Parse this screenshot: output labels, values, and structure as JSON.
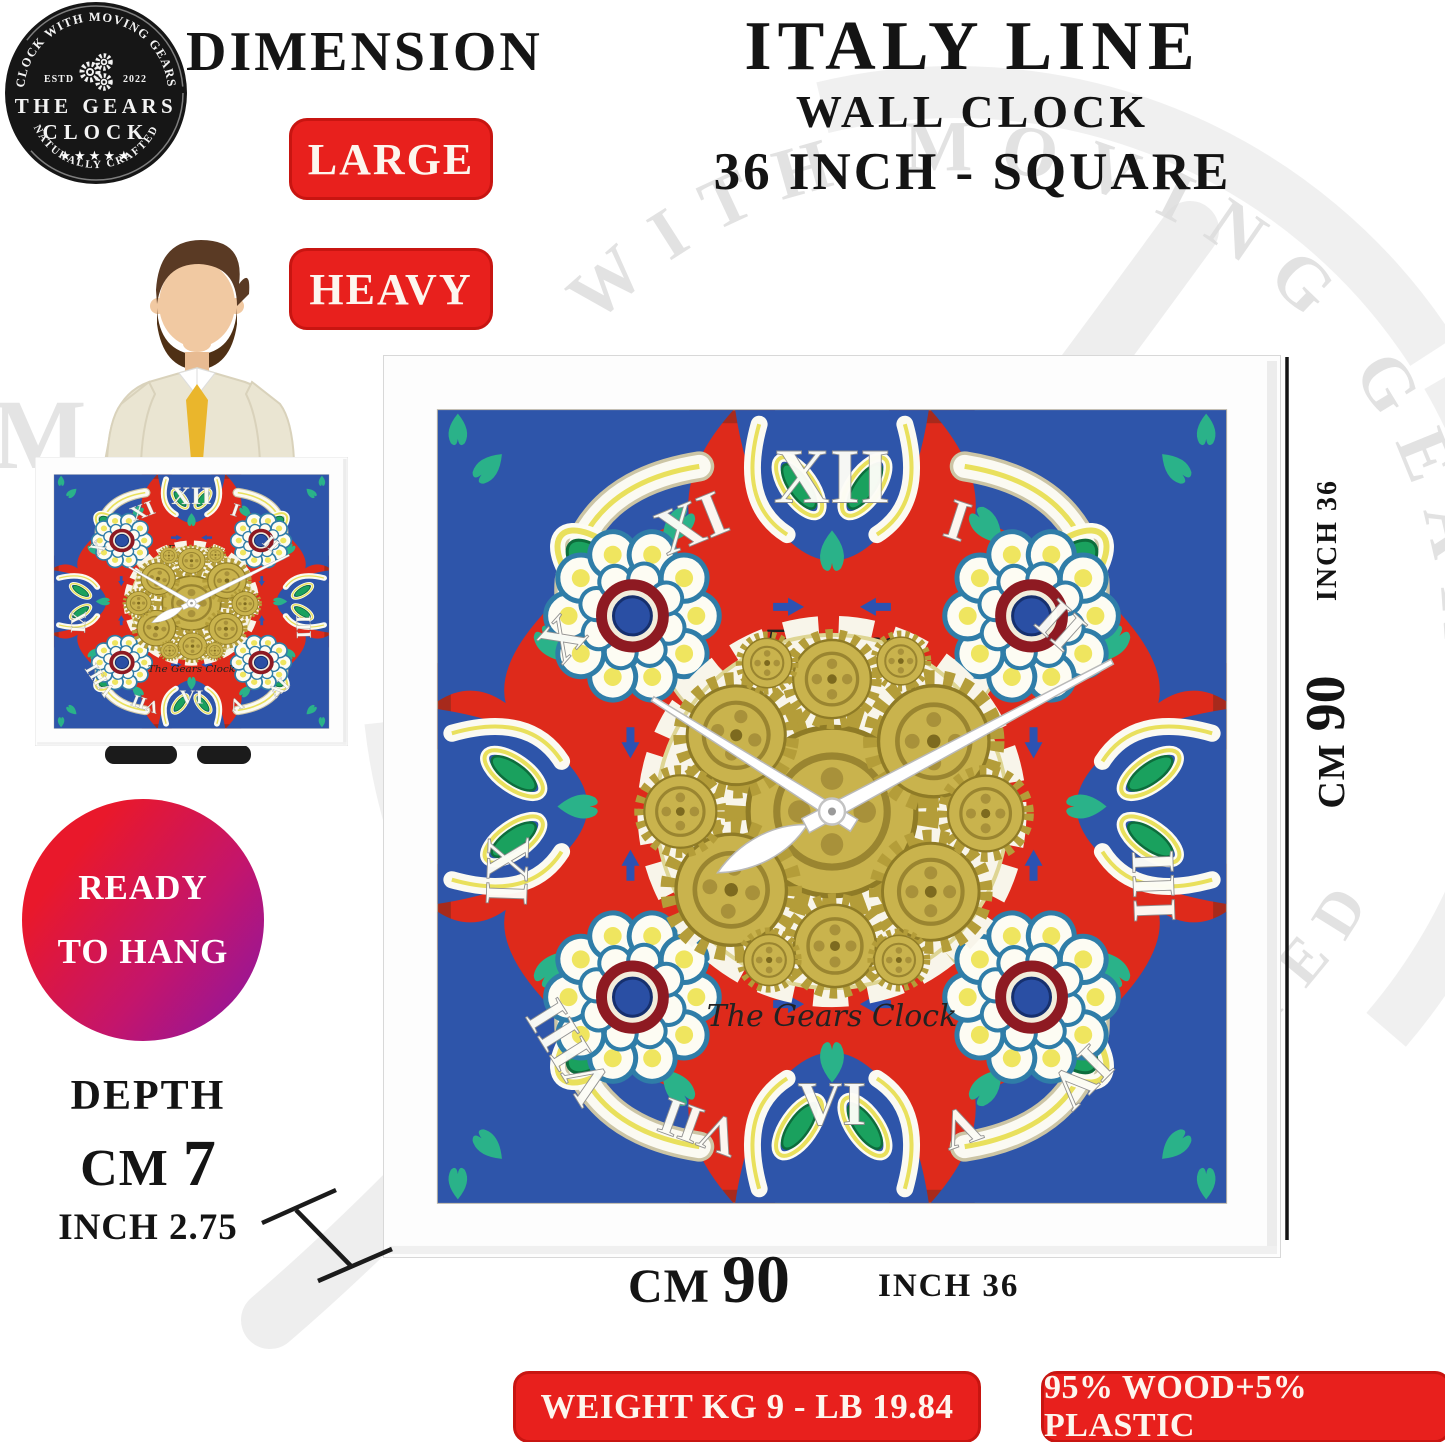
{
  "logo": {
    "ring_top": "CLOCK WITH MOVING GEARS",
    "estd": "ESTD",
    "year": "2022",
    "name_top": "THE GEARS",
    "name_bottom": "CLOCK",
    "stars": "★★★★★",
    "ring_bottom": "NATURALLY CRAFTED"
  },
  "header": {
    "dimension": "DIMENSION",
    "title1": "ITALY LINE",
    "title2": "WALL CLOCK",
    "title3": "36 INCH - SQUARE"
  },
  "badges": {
    "large": "LARGE",
    "heavy": "HEAVY",
    "weight": "WEIGHT KG 9 - LB 19.84",
    "material": "95% WOOD+5% PLASTIC"
  },
  "ready": {
    "line1": "READY",
    "line2": "TO HANG"
  },
  "depth": {
    "label": "DEPTH",
    "cm_unit": "CM",
    "cm_value": "7",
    "inch": "INCH 2.75"
  },
  "dims": {
    "right_inch": "INCH 36",
    "right_cm_unit": "CM",
    "right_cm_value": "90",
    "bottom_cm_unit": "CM",
    "bottom_cm_value": "90",
    "bottom_inch": "INCH 36"
  },
  "clock": {
    "brand_script": "Furore",
    "maker_script": "The Gears Clock",
    "time_shown": "10:10",
    "numerals": [
      "XII",
      "I",
      "II",
      "III",
      "IV",
      "V",
      "VI",
      "VII",
      "VIII",
      "IX",
      "X",
      "XI"
    ]
  },
  "watermark": {
    "ring_top": "CLOCK WITH MOVING GEARS",
    "ring_bottom": "NATURALLY CRAFTED"
  },
  "colors": {
    "badge_red": "#e8201d",
    "tile_red": "#de2a1b",
    "tile_blue": "#2e55aa",
    "gear_gold": "#c9b34d",
    "rosette_ring_red": "#8e1a22",
    "leaf_green": "#1aa15e",
    "ready_gradient_start": "#e9182b",
    "ready_gradient_end": "#8f169f"
  }
}
